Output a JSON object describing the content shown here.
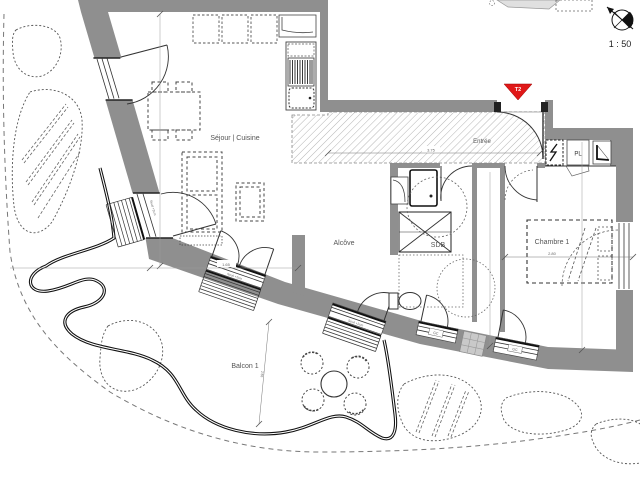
{
  "plan": {
    "title": "Plan d'appartement T2",
    "scale_label": "1 : 50",
    "unit_marker": "T2",
    "rooms": {
      "sejour": "Séjour | Cuisine",
      "entree": "Entrée",
      "alcove": "Alcôve",
      "sdb": "SDB",
      "chambre": "Chambre 1",
      "balcon": "Balcon 1",
      "placard": "PL"
    },
    "annotations": {
      "seuil_left_door": "Seuil +2cm",
      "seuil_sejour_bay": "Seuil +2cm",
      "seuil_alcove_bay": "Seuil +2cm",
      "gc_1": "GC",
      "gc_2": "GC"
    },
    "dimensions": {
      "entree_width": "3.75",
      "alcove_width": "1.65",
      "chambre_width": "2.80",
      "balcon_depth": "2.55"
    },
    "icons": {
      "north": "north-arrow-icon",
      "shaft": "lightning-icon"
    },
    "colors": {
      "wall": "#8f8f8f",
      "line": "#222222",
      "hatch": "#b5b5b5",
      "marker_red": "#e01818"
    }
  }
}
